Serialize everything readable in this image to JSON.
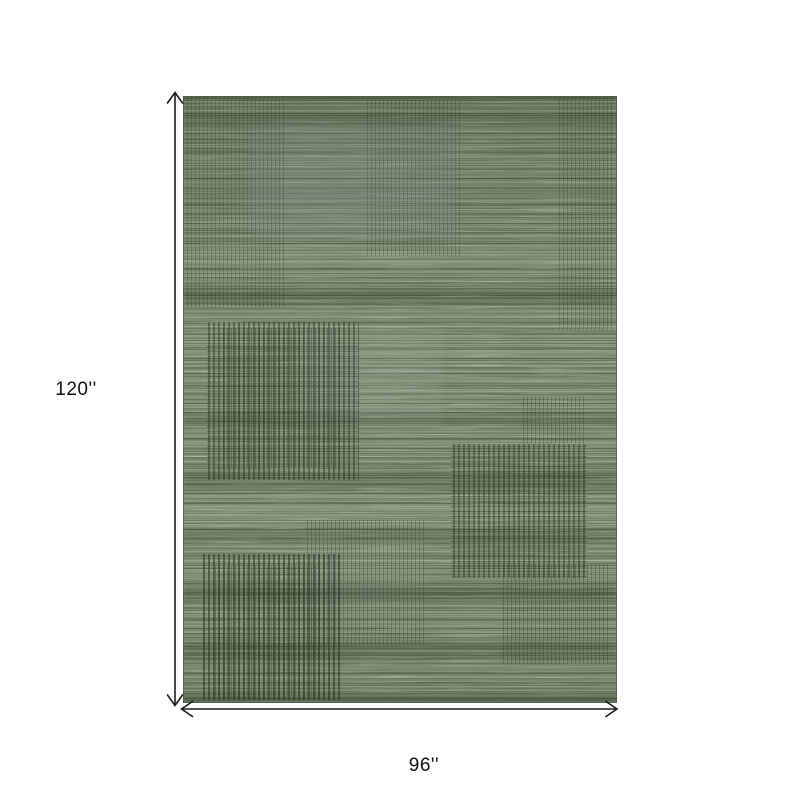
{
  "diagram": {
    "type": "product-dimension-diagram",
    "height_label": "120''",
    "width_label": "96''"
  },
  "rug": {
    "pattern": "distressed heathered plaid with pinstripe blocks",
    "colors": {
      "base_green": "#7e8b74",
      "light_heather": "#a3b093",
      "dark_streak": "#46543c",
      "pinstripe_dark": "#26331f",
      "gray_patch": "#8d9699"
    }
  },
  "annotation": {
    "line_color": "#1c1c1c",
    "label_color": "#111111",
    "background": "#ffffff"
  }
}
